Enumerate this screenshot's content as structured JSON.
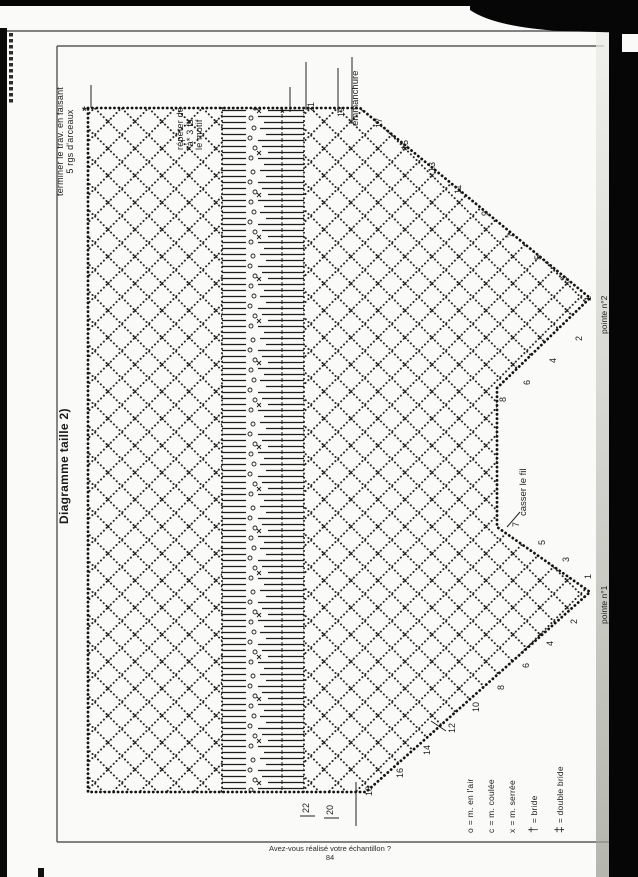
{
  "title": "Diagramme taille 2)",
  "notes": {
    "finish_line1": "terminer le trav. en faisant",
    "finish_line2": "5 rgs d'arceaux",
    "repeat_line1": "répéter de",
    "repeat_line2": "*à* 3 fs",
    "repeat_line3": "le motif",
    "armhole": "emmanchure",
    "cut_thread": "casser le fil",
    "star": "*"
  },
  "points": {
    "point2": "pointe n°2",
    "point1": "pointe n°1"
  },
  "numbers": {
    "top_edge": [
      "21",
      "19"
    ],
    "point2_upper": [
      "17",
      "15",
      "13",
      "11",
      "9",
      "7",
      "5",
      "3",
      "1"
    ],
    "point2_lower": [
      "2",
      "4",
      "6",
      "8"
    ],
    "point1_upper": [
      "7",
      "5",
      "3",
      "1"
    ],
    "point1_lower": [
      "2",
      "4",
      "6",
      "8",
      "10",
      "12",
      "14",
      "16",
      "18"
    ],
    "bottom_edge": [
      "22",
      "20"
    ]
  },
  "legend": {
    "items": [
      {
        "symbol": "o",
        "label": "= m. en l'air"
      },
      {
        "symbol": "c",
        "label": "= m. coulée"
      },
      {
        "symbol": "x",
        "label": "= m. serrée"
      },
      {
        "symbol": "†",
        "label": "= bride"
      },
      {
        "symbol": "‡",
        "label": "= double bride"
      }
    ]
  },
  "footer": {
    "question": "Avez-vous réalisé votre échantillon ?",
    "page": "84"
  }
}
